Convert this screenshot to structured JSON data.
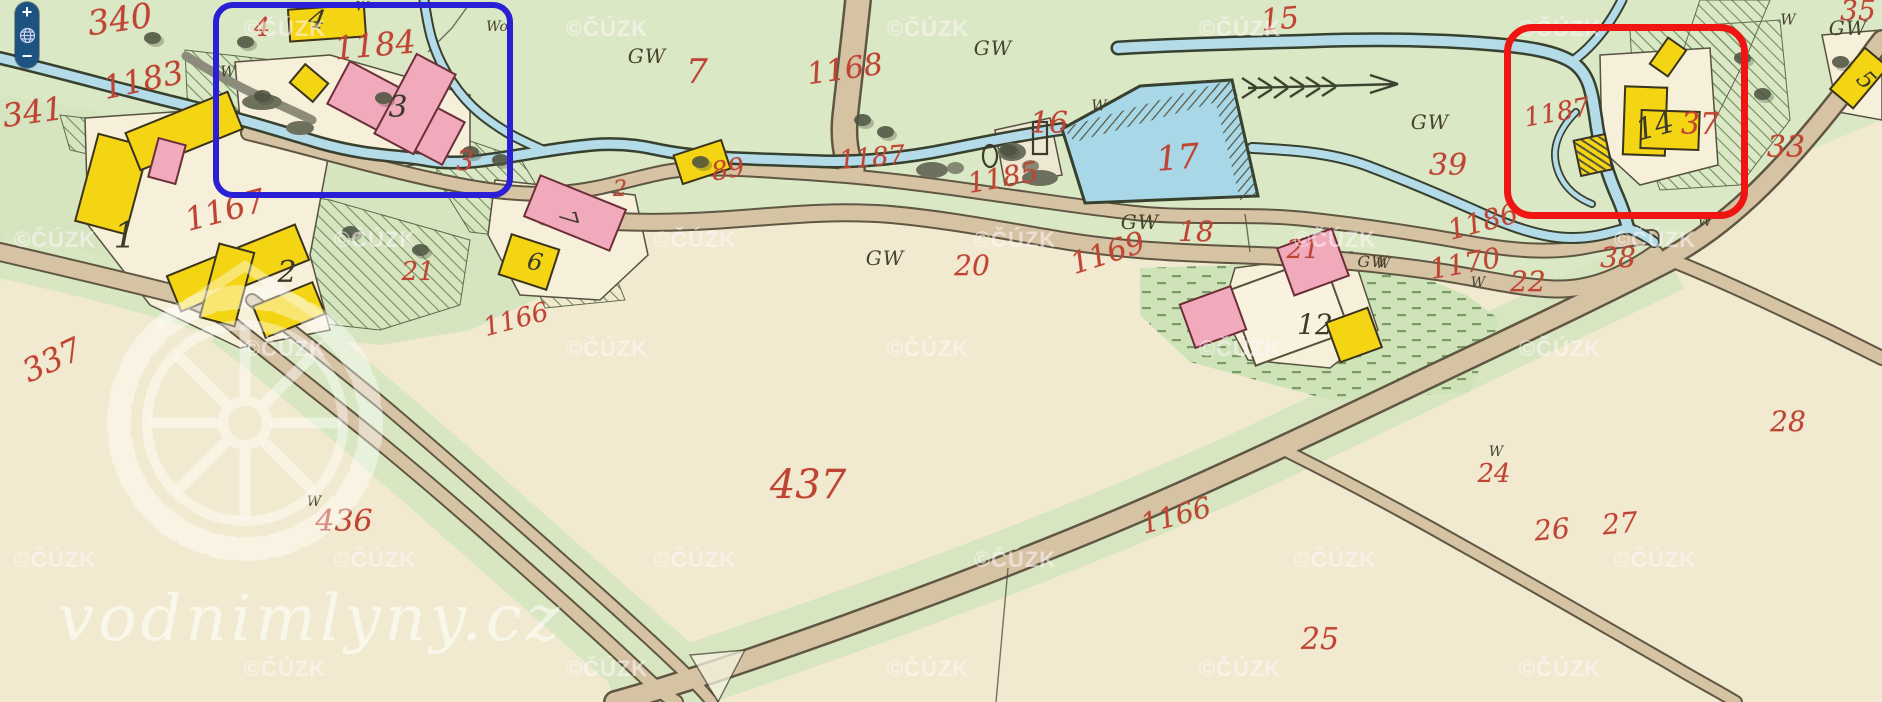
{
  "map": {
    "attribution": "©ČÚZK",
    "brand": "vodnimlyny.cz",
    "zoom_control": {
      "zoom_in": "+",
      "zoom_out": "−",
      "globe_icon": "globe"
    },
    "annotations": {
      "blue_box": {
        "color": "#2a1fd4",
        "around": "mill site houses 3 and 4"
      },
      "red_box": {
        "color": "#ee1512",
        "around": "mill site house 14 parcel 37"
      }
    },
    "colors": {
      "meadow_green": "#dbe8c6",
      "field_cream": "#f2ead0",
      "water_blue": "#b3dce8",
      "road_tan": "#d6c3a4",
      "building_yellow": "#f4d514",
      "building_pink": "#f0aabc",
      "number_red": "#bf4433",
      "number_black": "#3c3a2c"
    },
    "watermarks": {
      "text": "©ČÚZK",
      "rows": [
        {
          "y": 29,
          "xs": [
            285,
            607,
            928,
            1240,
            1560
          ]
        },
        {
          "y": 240,
          "xs": [
            55,
            375,
            695,
            1015,
            1335,
            1655
          ]
        },
        {
          "y": 349,
          "xs": [
            285,
            607,
            928,
            1240,
            1560
          ]
        },
        {
          "y": 560,
          "xs": [
            55,
            375,
            695,
            1015,
            1335,
            1655
          ]
        },
        {
          "y": 669,
          "xs": [
            285,
            607,
            928,
            1240,
            1560
          ]
        }
      ]
    },
    "labels": [
      {
        "t": "340",
        "x": 120,
        "y": 20,
        "s": 34,
        "r": -8,
        "c": "red"
      },
      {
        "t": "1183",
        "x": 143,
        "y": 80,
        "s": 32,
        "r": -12,
        "c": "red"
      },
      {
        "t": "341",
        "x": 33,
        "y": 112,
        "s": 32,
        "r": -8,
        "c": "red"
      },
      {
        "t": "4",
        "x": 262,
        "y": 28,
        "s": 26,
        "r": 0,
        "c": "red"
      },
      {
        "t": "1184",
        "x": 375,
        "y": 45,
        "s": 32,
        "r": -5,
        "c": "red"
      },
      {
        "t": "3",
        "x": 465,
        "y": 161,
        "s": 28,
        "r": 0,
        "c": "red"
      },
      {
        "t": "1167",
        "x": 225,
        "y": 210,
        "s": 32,
        "r": -15,
        "c": "red"
      },
      {
        "t": "337",
        "x": 52,
        "y": 360,
        "s": 32,
        "r": -25,
        "c": "red"
      },
      {
        "t": "21",
        "x": 418,
        "y": 272,
        "s": 26,
        "r": 0,
        "c": "red"
      },
      {
        "t": "1166",
        "x": 516,
        "y": 320,
        "s": 26,
        "r": -15,
        "c": "red"
      },
      {
        "t": "2",
        "x": 620,
        "y": 190,
        "s": 22,
        "r": 0,
        "c": "red"
      },
      {
        "t": "89",
        "x": 728,
        "y": 170,
        "s": 26,
        "r": -10,
        "c": "red"
      },
      {
        "t": "7",
        "x": 697,
        "y": 72,
        "s": 34,
        "r": 0,
        "c": "red"
      },
      {
        "t": "1168",
        "x": 845,
        "y": 70,
        "s": 30,
        "r": -8,
        "c": "red"
      },
      {
        "t": "1187",
        "x": 872,
        "y": 158,
        "s": 26,
        "r": -5,
        "c": "red"
      },
      {
        "t": "15",
        "x": 1280,
        "y": 20,
        "s": 30,
        "r": -5,
        "c": "red"
      },
      {
        "t": "16",
        "x": 1049,
        "y": 124,
        "s": 30,
        "r": 0,
        "c": "red"
      },
      {
        "t": "1185",
        "x": 1003,
        "y": 178,
        "s": 28,
        "r": -10,
        "c": "red"
      },
      {
        "t": "17",
        "x": 1178,
        "y": 158,
        "s": 34,
        "r": -5,
        "c": "red"
      },
      {
        "t": "18",
        "x": 1196,
        "y": 232,
        "s": 28,
        "r": 0,
        "c": "red"
      },
      {
        "t": "20",
        "x": 972,
        "y": 266,
        "s": 28,
        "r": 0,
        "c": "red"
      },
      {
        "t": "1169",
        "x": 1108,
        "y": 254,
        "s": 30,
        "r": -18,
        "c": "red"
      },
      {
        "t": "21",
        "x": 1303,
        "y": 250,
        "s": 26,
        "r": 0,
        "c": "red"
      },
      {
        "t": "1170",
        "x": 1465,
        "y": 264,
        "s": 28,
        "r": -10,
        "c": "red"
      },
      {
        "t": "22",
        "x": 1528,
        "y": 282,
        "s": 28,
        "r": 0,
        "c": "red"
      },
      {
        "t": "38",
        "x": 1618,
        "y": 258,
        "s": 28,
        "r": 0,
        "c": "red"
      },
      {
        "t": "1186",
        "x": 1483,
        "y": 222,
        "s": 28,
        "r": -15,
        "c": "red"
      },
      {
        "t": "39",
        "x": 1448,
        "y": 166,
        "s": 30,
        "r": 0,
        "c": "red"
      },
      {
        "t": "1187",
        "x": 1557,
        "y": 113,
        "s": 26,
        "r": -10,
        "c": "red"
      },
      {
        "t": "37",
        "x": 1700,
        "y": 125,
        "s": 30,
        "r": 0,
        "c": "red"
      },
      {
        "t": "33",
        "x": 1786,
        "y": 148,
        "s": 30,
        "r": 0,
        "c": "red"
      },
      {
        "t": "35",
        "x": 1858,
        "y": 11,
        "s": 28,
        "r": 0,
        "c": "red"
      },
      {
        "t": "437",
        "x": 808,
        "y": 485,
        "s": 40,
        "r": 0,
        "c": "red"
      },
      {
        "t": "436",
        "x": 344,
        "y": 522,
        "s": 30,
        "r": 0,
        "c": "red"
      },
      {
        "t": "1166",
        "x": 1176,
        "y": 516,
        "s": 28,
        "r": -15,
        "c": "red"
      },
      {
        "t": "25",
        "x": 1320,
        "y": 640,
        "s": 30,
        "r": 0,
        "c": "red"
      },
      {
        "t": "24",
        "x": 1494,
        "y": 474,
        "s": 26,
        "r": 0,
        "c": "red"
      },
      {
        "t": "26",
        "x": 1552,
        "y": 530,
        "s": 28,
        "r": -5,
        "c": "red"
      },
      {
        "t": "27",
        "x": 1620,
        "y": 524,
        "s": 28,
        "r": -5,
        "c": "red"
      },
      {
        "t": "28",
        "x": 1788,
        "y": 422,
        "s": 28,
        "r": 0,
        "c": "red"
      },
      {
        "t": "1",
        "x": 125,
        "y": 237,
        "s": 36,
        "r": 0,
        "c": "blk"
      },
      {
        "t": "2",
        "x": 287,
        "y": 273,
        "s": 30,
        "r": 0,
        "c": "blk"
      },
      {
        "t": "3",
        "x": 398,
        "y": 108,
        "s": 30,
        "r": 0,
        "c": "blk"
      },
      {
        "t": "4",
        "x": 317,
        "y": 20,
        "s": 26,
        "r": 10,
        "c": "blk"
      },
      {
        "t": "6",
        "x": 535,
        "y": 262,
        "s": 24,
        "r": 10,
        "c": "blk"
      },
      {
        "t": "7",
        "x": 568,
        "y": 218,
        "s": 24,
        "r": 75,
        "c": "blk"
      },
      {
        "t": "12",
        "x": 1315,
        "y": 325,
        "s": 28,
        "r": 0,
        "c": "blk"
      },
      {
        "t": "14",
        "x": 1655,
        "y": 127,
        "s": 30,
        "r": -15,
        "c": "blk"
      },
      {
        "t": "5",
        "x": 1866,
        "y": 80,
        "s": 24,
        "r": 45,
        "c": "blk"
      },
      {
        "t": "GW",
        "x": 647,
        "y": 56,
        "s": 20,
        "r": 0,
        "c": "gw"
      },
      {
        "t": "GW",
        "x": 993,
        "y": 48,
        "s": 20,
        "r": 0,
        "c": "gw"
      },
      {
        "t": "GW",
        "x": 885,
        "y": 258,
        "s": 20,
        "r": 0,
        "c": "gw"
      },
      {
        "t": "GW",
        "x": 1140,
        "y": 222,
        "s": 20,
        "r": 0,
        "c": "gw"
      },
      {
        "t": "GW",
        "x": 1373,
        "y": 262,
        "s": 16,
        "r": 0,
        "c": "gw"
      },
      {
        "t": "GW",
        "x": 1430,
        "y": 122,
        "s": 20,
        "r": 0,
        "c": "gw"
      },
      {
        "t": "GW",
        "x": 1848,
        "y": 28,
        "s": 20,
        "r": 0,
        "c": "gw"
      },
      {
        "t": "W",
        "x": 228,
        "y": 72,
        "s": 15,
        "r": 0,
        "c": "w"
      },
      {
        "t": "Wo",
        "x": 497,
        "y": 27,
        "s": 14,
        "r": 0,
        "c": "w"
      },
      {
        "t": "W",
        "x": 362,
        "y": 7,
        "s": 13,
        "r": 0,
        "c": "w"
      },
      {
        "t": "W",
        "x": 1099,
        "y": 106,
        "s": 15,
        "r": 0,
        "c": "w"
      },
      {
        "t": "W",
        "x": 1478,
        "y": 283,
        "s": 14,
        "r": 0,
        "c": "w"
      },
      {
        "t": "W",
        "x": 1496,
        "y": 452,
        "s": 14,
        "r": 0,
        "c": "w"
      },
      {
        "t": "W",
        "x": 314,
        "y": 502,
        "s": 14,
        "r": 0,
        "c": "w"
      },
      {
        "t": "W",
        "x": 1788,
        "y": 20,
        "s": 15,
        "r": 0,
        "c": "w"
      },
      {
        "t": "W",
        "x": 1705,
        "y": 222,
        "s": 14,
        "r": 0,
        "c": "w"
      },
      {
        "t": "W",
        "x": 1383,
        "y": 264,
        "s": 14,
        "r": 0,
        "c": "w"
      }
    ],
    "buildings": [
      {
        "x": 288,
        "y": 6,
        "w": 78,
        "h": 34,
        "r": -4,
        "c": "y"
      },
      {
        "x": 293,
        "y": 70,
        "w": 32,
        "h": 26,
        "r": 40,
        "c": "y"
      },
      {
        "x": 330,
        "y": 88,
        "w": 132,
        "h": 50,
        "r": 28,
        "c": "p"
      },
      {
        "x": 392,
        "y": 58,
        "w": 46,
        "h": 92,
        "r": 28,
        "c": "p"
      },
      {
        "x": 85,
        "y": 138,
        "w": 54,
        "h": 92,
        "r": 15,
        "c": "y"
      },
      {
        "x": 128,
        "y": 110,
        "w": 112,
        "h": 42,
        "r": -22,
        "c": "y"
      },
      {
        "x": 152,
        "y": 140,
        "w": 30,
        "h": 42,
        "r": 15,
        "c": "p"
      },
      {
        "x": 168,
        "y": 248,
        "w": 140,
        "h": 40,
        "r": -22,
        "c": "y"
      },
      {
        "x": 208,
        "y": 246,
        "w": 38,
        "h": 78,
        "r": 15,
        "c": "y"
      },
      {
        "x": 256,
        "y": 292,
        "w": 66,
        "h": 36,
        "r": -22,
        "c": "y"
      },
      {
        "x": 503,
        "y": 240,
        "w": 52,
        "h": 44,
        "r": 18,
        "c": "y"
      },
      {
        "x": 528,
        "y": 190,
        "w": 94,
        "h": 46,
        "r": 22,
        "c": "p"
      },
      {
        "x": 676,
        "y": 146,
        "w": 52,
        "h": 32,
        "r": -18,
        "c": "y"
      },
      {
        "x": 1238,
        "y": 270,
        "w": 102,
        "h": 82,
        "r": -20,
        "c": "w"
      },
      {
        "x": 1283,
        "y": 236,
        "w": 60,
        "h": 52,
        "r": -20,
        "c": "p"
      },
      {
        "x": 1185,
        "y": 293,
        "w": 56,
        "h": 48,
        "r": -20,
        "c": "p"
      },
      {
        "x": 1331,
        "y": 313,
        "w": 46,
        "h": 44,
        "r": -20,
        "c": "y"
      },
      {
        "x": 1623,
        "y": 86,
        "w": 44,
        "h": 70,
        "r": 2,
        "c": "y"
      },
      {
        "x": 1640,
        "y": 110,
        "w": 60,
        "h": 40,
        "r": 2,
        "c": "y"
      },
      {
        "x": 1656,
        "y": 40,
        "w": 24,
        "h": 34,
        "r": 35,
        "c": "y"
      },
      {
        "x": 1576,
        "y": 136,
        "w": 34,
        "h": 38,
        "r": -12,
        "c": "yh"
      },
      {
        "x": 1843,
        "y": 50,
        "w": 32,
        "h": 56,
        "r": 40,
        "c": "y"
      }
    ],
    "trees": [
      {
        "x": 152,
        "y": 38
      },
      {
        "x": 245,
        "y": 42
      },
      {
        "x": 262,
        "y": 96
      },
      {
        "x": 383,
        "y": 98
      },
      {
        "x": 470,
        "y": 152
      },
      {
        "x": 500,
        "y": 160
      },
      {
        "x": 700,
        "y": 162
      },
      {
        "x": 862,
        "y": 120
      },
      {
        "x": 885,
        "y": 132
      },
      {
        "x": 955,
        "y": 168,
        "g": 1
      },
      {
        "x": 1008,
        "y": 150
      },
      {
        "x": 1030,
        "y": 166,
        "g": 1
      },
      {
        "x": 350,
        "y": 232
      },
      {
        "x": 420,
        "y": 250
      },
      {
        "x": 1742,
        "y": 58
      },
      {
        "x": 1762,
        "y": 94
      },
      {
        "x": 1840,
        "y": 62
      }
    ]
  }
}
